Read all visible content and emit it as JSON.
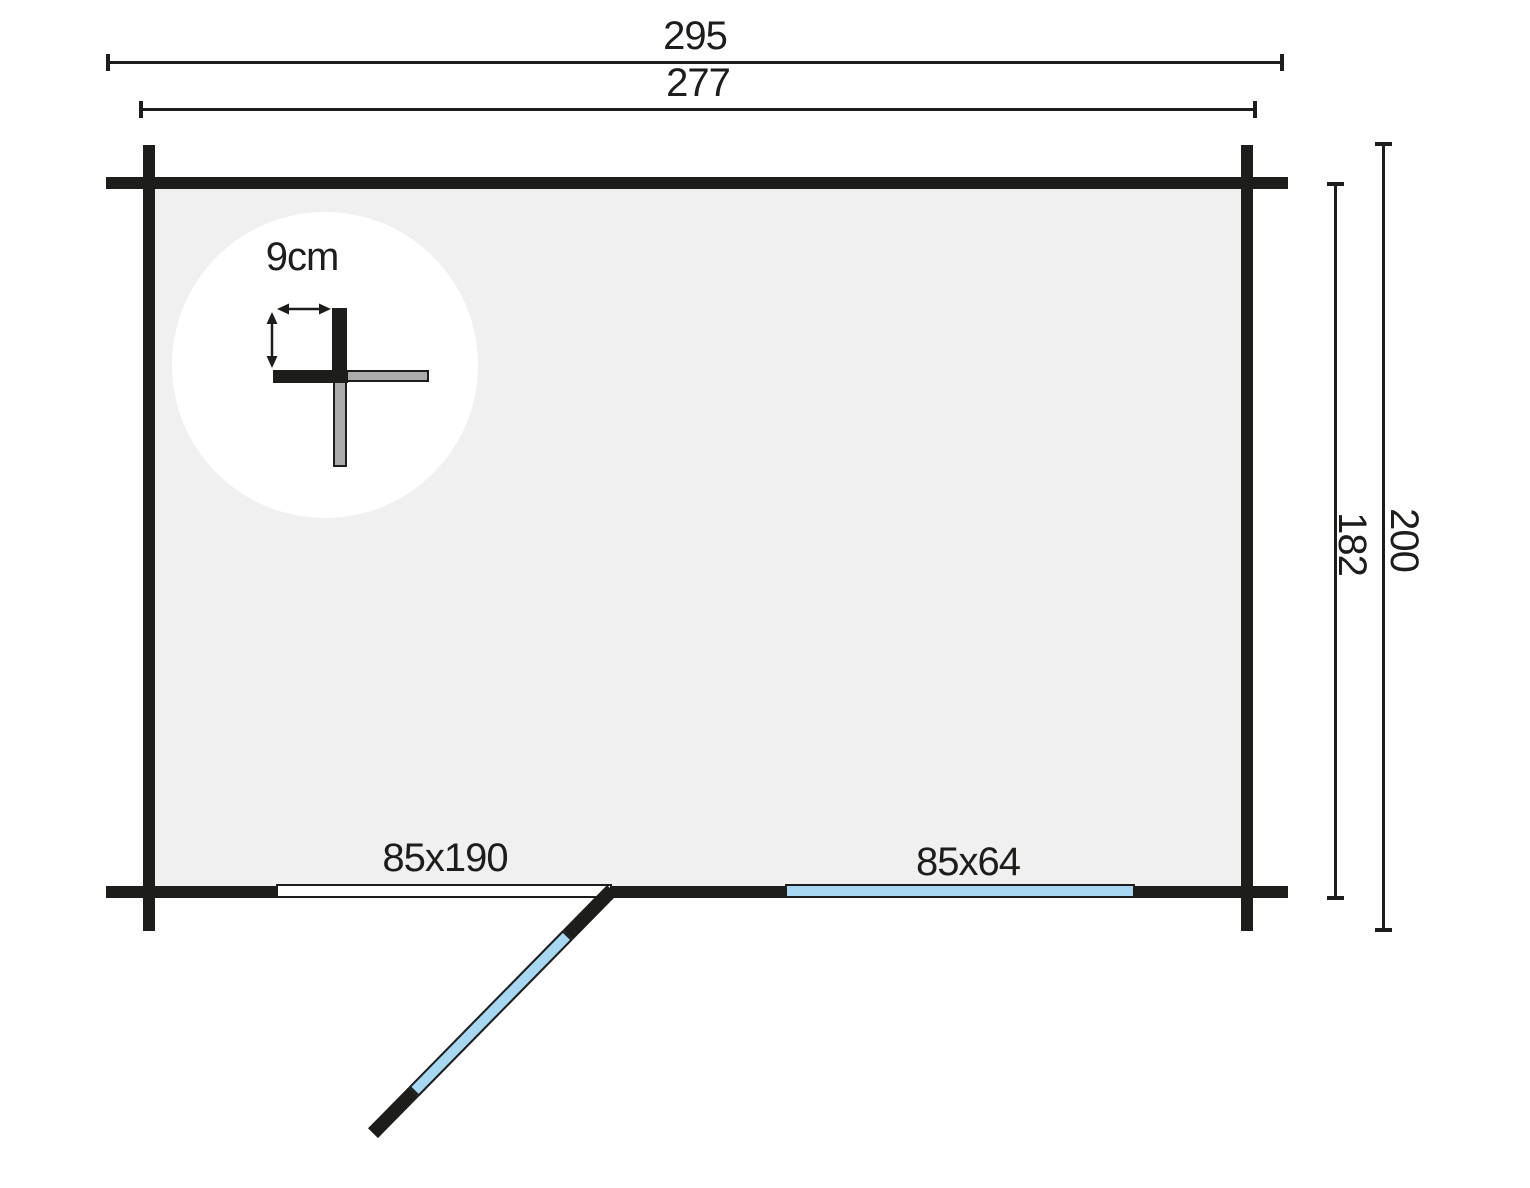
{
  "plan": {
    "dimension_labels": {
      "total_width": "295",
      "wall_outer_width": "277",
      "inner_depth": "182",
      "total_depth": "200"
    },
    "wall_detail_label": "9cm",
    "door_label": "85x190",
    "window_label": "85x64"
  },
  "colors": {
    "line": "#1d1d1b",
    "floor": "#f0f0f0",
    "opening": "#a8d7f2",
    "log": "#ababab",
    "bg": "#ffffff"
  }
}
